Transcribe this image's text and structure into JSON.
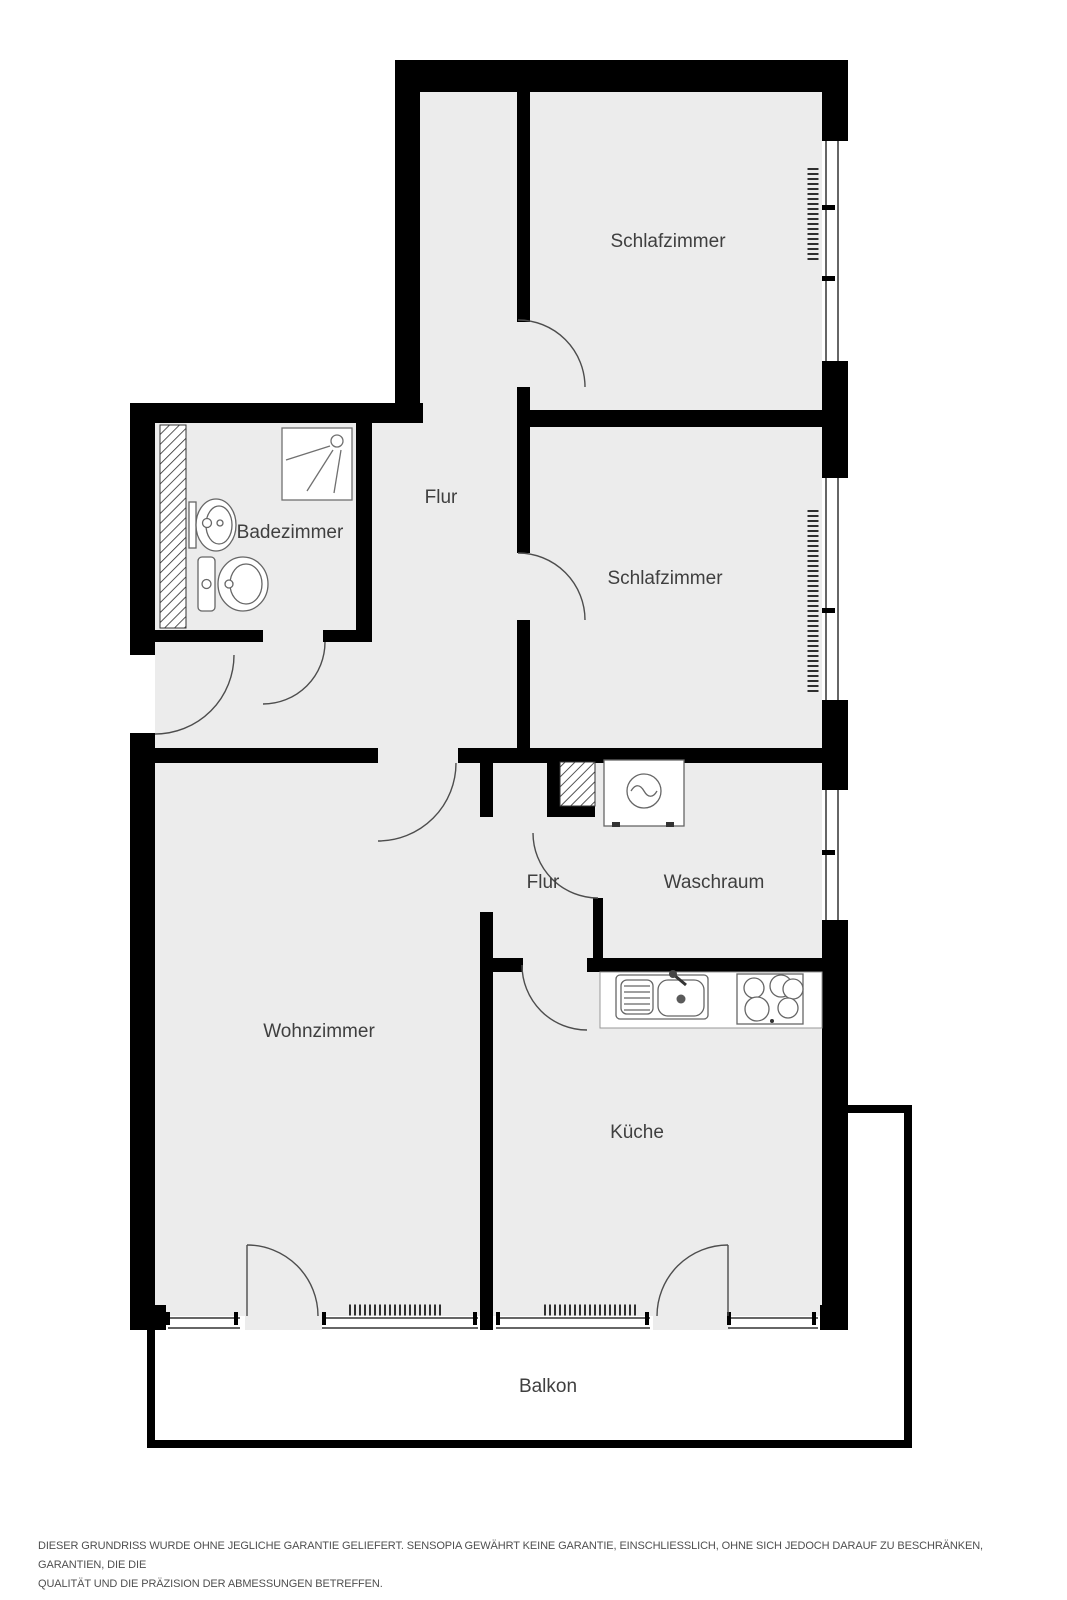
{
  "rooms": {
    "schlafzimmer_top": {
      "label": "Schlafzimmer"
    },
    "schlafzimmer_mid": {
      "label": "Schlafzimmer"
    },
    "flur_upper": {
      "label": "Flur"
    },
    "flur_lower": {
      "label": "Flur"
    },
    "badezimmer": {
      "label": "Badezimmer"
    },
    "waschraum": {
      "label": "Waschraum"
    },
    "wohnzimmer": {
      "label": "Wohnzimmer"
    },
    "kueche": {
      "label": "Küche"
    },
    "balkon": {
      "label": "Balkon"
    }
  },
  "disclaimer": {
    "line1": "DIESER GRUNDRISS WURDE OHNE JEGLICHE GARANTIE GELIEFERT. SENSOPIA GEWÄHRT KEINE GARANTIE, EINSCHLIESSLICH, OHNE SICH JEDOCH DARAUF ZU BESCHRÄNKEN, GARANTIEN, DIE DIE",
    "line2": "QUALITÄT UND DIE PRÄZISION DER ABMESSUNGEN BETREFFEN."
  },
  "fixtures": {
    "shower": "shower-tray",
    "washbasin": "washbasin",
    "toilet": "toilet",
    "washing_machine": "washing-machine",
    "kitchen_sink": "kitchen-sink-with-drainer",
    "stove": "stove-4-burners",
    "radiator_count": 4
  },
  "colors": {
    "background": "#ffffff",
    "room_fill": "#ececec",
    "wall": "#000000",
    "label_text": "#3f3f3f",
    "fixture_line": "#666666",
    "disclaimer_text": "#4f4f4f"
  }
}
